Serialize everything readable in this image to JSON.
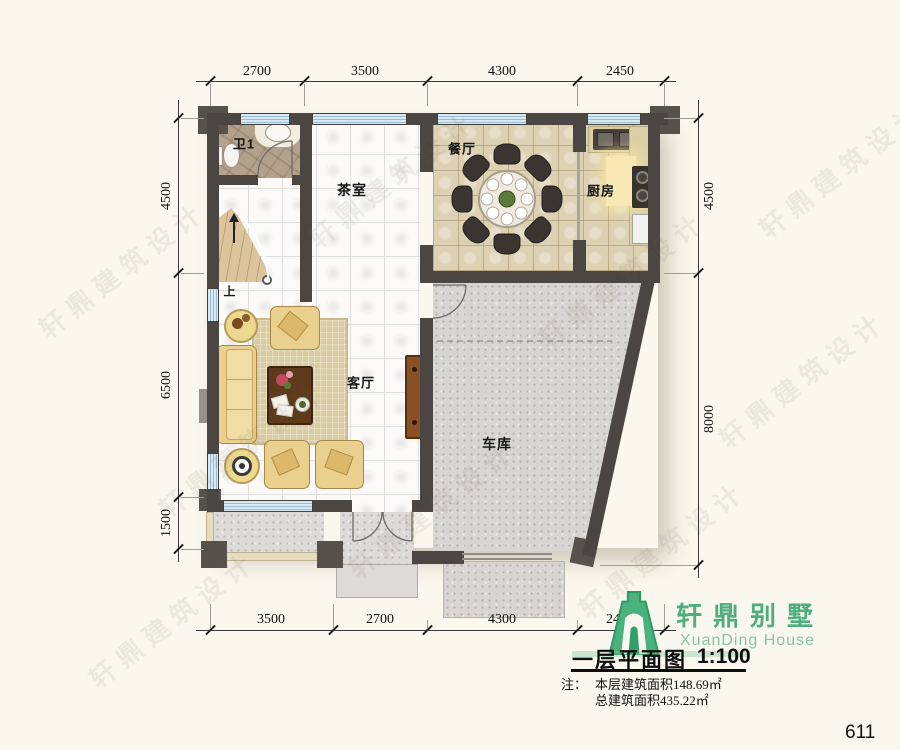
{
  "plan": {
    "rooms": {
      "bath": {
        "label": "卫1"
      },
      "tea_room": {
        "label": "茶室"
      },
      "dining": {
        "label": "餐厅"
      },
      "kitchen": {
        "label": "厨房"
      },
      "living": {
        "label": "客厅"
      },
      "garage": {
        "label": "车库"
      },
      "stair_up": {
        "label": "上"
      }
    },
    "dimensions": {
      "top": [
        "2700",
        "3500",
        "4300",
        "2450"
      ],
      "left": [
        "4500",
        "6500",
        "1500"
      ],
      "right": [
        "4500",
        "8000"
      ],
      "bottom": [
        "3500",
        "2700",
        "4300",
        "2450"
      ]
    }
  },
  "branding": {
    "logo_cn": "轩鼎别墅",
    "logo_en": "XuanDing House"
  },
  "title_block": {
    "title": "一层平面图",
    "scale": "1:100",
    "note_label": "注：",
    "note_line1": "本层建筑面积148.69㎡",
    "note_line2": "总建筑面积435.22㎡"
  },
  "page_number": "611",
  "watermark_text": "轩鼎建筑设计",
  "colors": {
    "wall": "#4c4642",
    "window_glass": "#d7e8f2",
    "brand_green": "#4fae7e",
    "dining_tile": "#ddd1b4",
    "garage_concrete": "#d6d5d1"
  }
}
